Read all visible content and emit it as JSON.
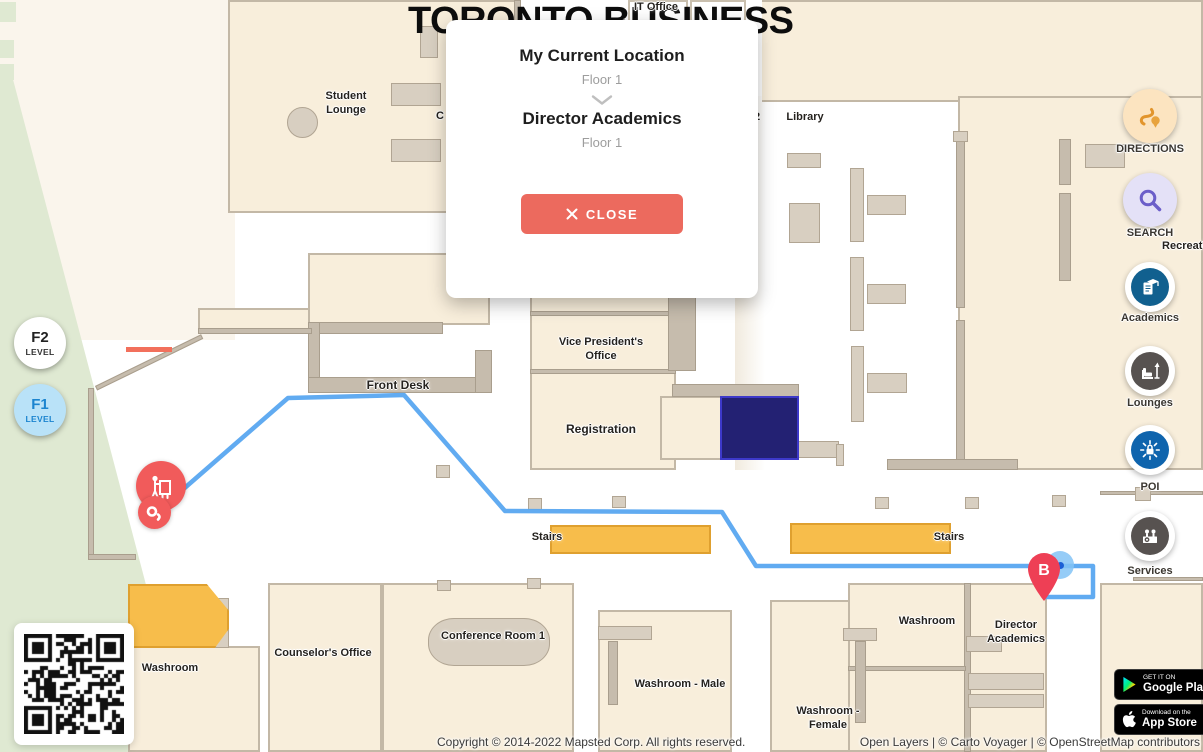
{
  "map": {
    "title": "TORONTO BUSINESS",
    "destination_label": "B",
    "labels": [
      {
        "id": "student-lounge",
        "text": "Student Lounge"
      },
      {
        "id": "it-office",
        "text": "IT Office"
      },
      {
        "id": "room-number-2",
        "text": "2"
      },
      {
        "id": "library",
        "text": "Library"
      },
      {
        "id": "partial-label-c",
        "text": "C"
      },
      {
        "id": "finance-and-hr",
        "text": "Finance and HR"
      },
      {
        "id": "vice-presidents-office",
        "text": "Vice President's Office"
      },
      {
        "id": "front-desk",
        "text": "Front Desk"
      },
      {
        "id": "registration",
        "text": "Registration"
      },
      {
        "id": "stairs-left",
        "text": "Stairs"
      },
      {
        "id": "stairs-right",
        "text": "Stairs"
      },
      {
        "id": "recreation-area",
        "text": "Recreation Area"
      },
      {
        "id": "washroom-left",
        "text": "Washroom"
      },
      {
        "id": "counselors-office",
        "text": "Counselor's Office"
      },
      {
        "id": "conference-room-1",
        "text": "Conference Room 1"
      },
      {
        "id": "washroom-male",
        "text": "Washroom - Male"
      },
      {
        "id": "washroom-female",
        "text": "Washroom - Female"
      },
      {
        "id": "washroom-right",
        "text": "Washroom"
      },
      {
        "id": "director-academics",
        "text": "Director Academics"
      }
    ]
  },
  "popup": {
    "from_title": "My Current Location",
    "from_floor": "Floor 1",
    "to_title": "Director Academics",
    "to_floor": "Floor 1",
    "close_label": "CLOSE"
  },
  "sidebar": {
    "items": [
      {
        "label": "DIRECTIONS",
        "icon": "route-icon",
        "bg": "#fce4c0",
        "fg": "#e2952c"
      },
      {
        "label": "SEARCH",
        "icon": "magnifier-icon",
        "bg": "#e4e1f7",
        "fg": "#6b5ec9"
      },
      {
        "label": "Academics",
        "icon": "academics-icon",
        "bg": "#11608f",
        "fg": "#ffffff"
      },
      {
        "label": "Lounges",
        "icon": "lounge-icon",
        "bg": "#575250",
        "fg": "#ffffff"
      },
      {
        "label": "POI",
        "icon": "poi-icon",
        "bg": "#0f64ad",
        "fg": "#ffffff"
      },
      {
        "label": "Services",
        "icon": "services-icon",
        "bg": "#575250",
        "fg": "#ffffff"
      }
    ]
  },
  "levels": [
    {
      "label": "F2",
      "sub": "LEVEL",
      "active": false
    },
    {
      "label": "F1",
      "sub": "LEVEL",
      "active": true
    }
  ],
  "badges": {
    "google_play": {
      "tagline": "GET IT ON",
      "store": "Google Play"
    },
    "app_store": {
      "tagline": "Download on the",
      "store": "App Store"
    }
  },
  "attribution": {
    "copyright": "Copyright © 2014-2022 Mapsted Corp. All rights reserved.",
    "map_credits": "Open Layers | © Carto Voyager | © OpenStreetMap contributors"
  },
  "colors": {
    "route": "#58a6f0",
    "stairs": "#f7bd4b",
    "marker": "#f15b5b",
    "pin": "#ee3f55",
    "highlight_room": "#232173",
    "close_button": "#ec6a5e",
    "level_active_bg": "#b9e2f8",
    "level_active_fg": "#1b84cf"
  }
}
